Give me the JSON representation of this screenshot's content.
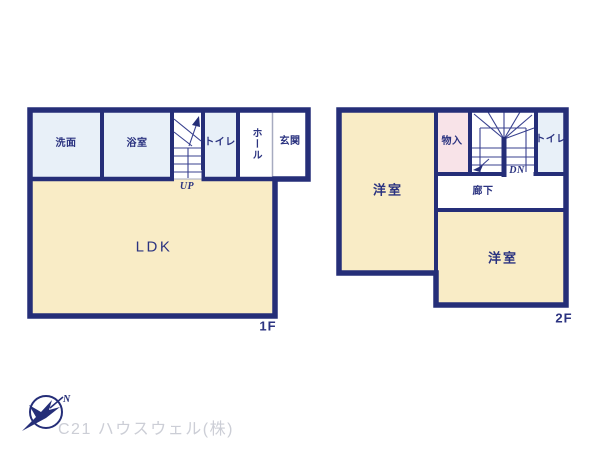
{
  "floors": {
    "f1": {
      "floor_label": "1F",
      "rooms": {
        "washroom": "洗面",
        "bathroom": "浴室",
        "toilet": "トイレ",
        "hall": "ホール",
        "entrance": "玄関",
        "ldk": "LDK"
      },
      "stair_direction_label": "UP"
    },
    "f2": {
      "floor_label": "2F",
      "rooms": {
        "bedroom_left": "洋室",
        "storage": "物入",
        "toilet": "トイレ",
        "corridor": "廊下",
        "bedroom_right": "洋室"
      },
      "stair_direction_label": "DN"
    }
  },
  "footer": {
    "company": "C21 ハウスウェル(株)",
    "compass_north_label": "N"
  },
  "palette": {
    "wall_navy": "#252e78",
    "room_cream": "#f9ecc6",
    "room_light_blue": "#e8f0f8",
    "room_pink": "#f8e3e8",
    "room_white": "#ffffff",
    "label_navy": "#2b3380",
    "divider_gray": "#a7abc0",
    "footer_gray": "#ccced6"
  }
}
